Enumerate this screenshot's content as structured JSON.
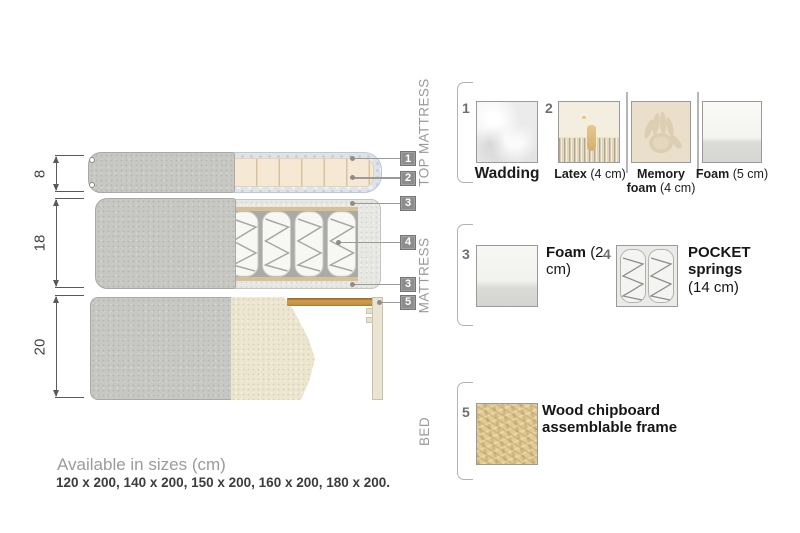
{
  "dimensions": {
    "labels": [
      "8",
      "18",
      "20"
    ]
  },
  "callouts": [
    "1",
    "2",
    "3",
    "4",
    "3",
    "5"
  ],
  "legend": {
    "sections": [
      {
        "title": "TOP MATTRESS",
        "items": [
          {
            "num": "1",
            "name": "Wadding",
            "size": ""
          },
          {
            "num": "2",
            "name": "Latex",
            "size": "(4 cm)"
          },
          {
            "num": "",
            "name": "Memory foam",
            "size": "(4 cm)"
          },
          {
            "num": "",
            "name": "Foam",
            "size": "(5 cm)"
          }
        ]
      },
      {
        "title": "MATTRESS",
        "items": [
          {
            "num": "3",
            "name": "Foam",
            "size": "(2 cm)"
          },
          {
            "num": "4",
            "name": "POCKET springs",
            "size": "(14 cm)"
          }
        ]
      },
      {
        "title": "BED",
        "items": [
          {
            "num": "5",
            "name": "Wood chipboard assemblable frame",
            "size": ""
          }
        ]
      }
    ]
  },
  "footer": {
    "title": "Available in sizes (cm)",
    "sizes": "120 x 200, 140 x 200, 150 x 200, 160 x 200, 180 x 200."
  },
  "colors": {
    "callout_badge": "#8d8d8d",
    "fabric_grey": "#c7c8c4",
    "foam_cream": "#f5e9d5",
    "wood_slat": "#c89544",
    "panel_speckle": "#e7e8e4",
    "drape_beige": "#ece5d0"
  }
}
